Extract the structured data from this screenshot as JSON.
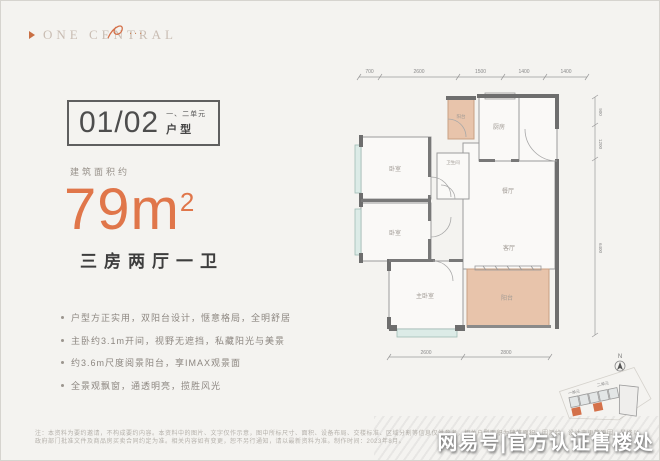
{
  "logo": {
    "text": "ONE CENTRAL",
    "dots": "..."
  },
  "unit_badge": {
    "number": "01/02",
    "note_line1": "一、二单元",
    "note_line2": "户型"
  },
  "area": {
    "prefix": "建筑面积约",
    "value": "79m",
    "sup": "2"
  },
  "layout_title": "三房两厅一卫",
  "features": [
    "户型方正实用，双阳台设计，惬意格局，全明舒居",
    "主卧约3.1m开间，视野无遮挡，私藏阳光与美景",
    "约3.6m尺度阅景阳台，享IMAX观景面",
    "全景观飘窗，通透明亮，揽胜风光"
  ],
  "floorplan": {
    "rooms": {
      "bedroom1": "卧室",
      "bedroom2": "卧室",
      "master": "主卧室",
      "bathroom": "卫生间",
      "balcony_top": "阳台",
      "kitchen": "厨房",
      "dining": "餐厅",
      "living": "客厅",
      "balcony_bottom": "阳台"
    },
    "dims_top": [
      "700",
      "2600",
      "1500",
      "1400",
      "1400"
    ],
    "dims_bottom": [
      "2600",
      "2800"
    ],
    "dims_right": [
      "900",
      "1200",
      "6400"
    ]
  },
  "siteplan": {
    "north": "N",
    "unit1": "一单元",
    "unit2": "二单元"
  },
  "disclaimer": {
    "line1": "注：本资料为要约邀请，不构成要约内容。本资料中的图片、文字仅作示意，图中所标尺寸、面积、设备布局、交楼标准、区域分割等信息仅供参考，相关户型面积为建筑面积，因测绘、设计变更等原因，最终以",
    "line2": "政府部门批准文件及商品房买卖合同约定为准。相关内容如有变更，恕不另行通知，请以最新资料为准。制作时间：2023年8月。"
  },
  "watermark": "网易号|官方认证售楼处",
  "colors": {
    "accent": "#E0764A",
    "wall": "#6E6E6E",
    "balcony_fill": "#E8C4AB",
    "window_fill": "#DCEBE7"
  }
}
